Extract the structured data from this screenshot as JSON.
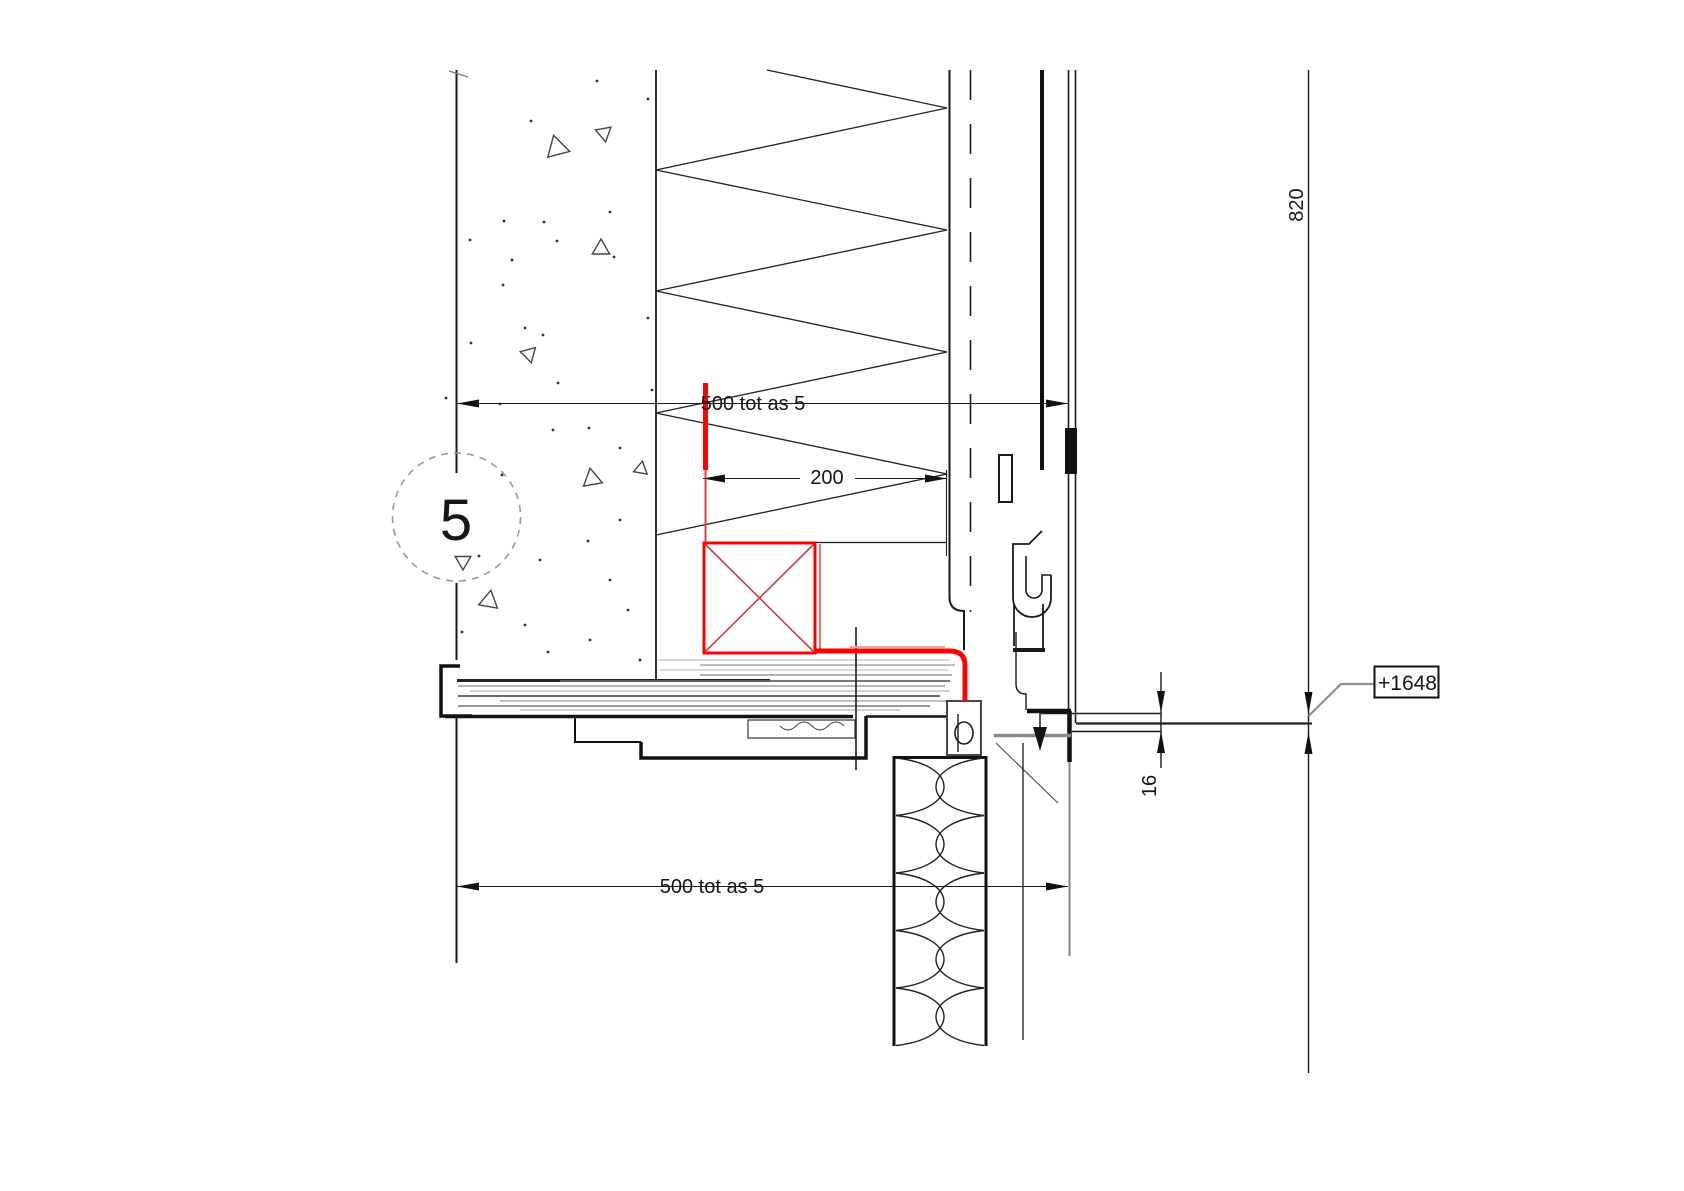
{
  "drawing_labels": {
    "dim_top": "500 tot as 5",
    "dim_mid": "200",
    "dim_bottom": "500 tot as 5",
    "dim_height": "820",
    "dim_gap": "16",
    "grid_bubble": "5",
    "level_tag": "+1648"
  },
  "colors": {
    "red_accent": "#ff0000",
    "red_soft": "#e04040",
    "red_light": "#ff9a9a",
    "line_dark": "#1a1a1a",
    "grain_gray": "#9a9a9a",
    "bar_gray": "#8a8a8a",
    "leader_gray": "#8f8f8f"
  },
  "stipple": {
    "dots": [
      [
        597,
        81
      ],
      [
        648,
        99
      ],
      [
        531,
        121
      ],
      [
        504,
        221
      ],
      [
        544,
        222
      ],
      [
        512,
        260
      ],
      [
        557,
        241
      ],
      [
        470,
        240
      ],
      [
        610,
        212
      ],
      [
        503,
        285
      ],
      [
        614,
        257
      ],
      [
        648,
        318
      ],
      [
        525,
        328
      ],
      [
        543,
        335
      ],
      [
        471,
        343
      ],
      [
        558,
        383
      ],
      [
        652,
        390
      ],
      [
        446,
        398
      ],
      [
        500,
        404
      ],
      [
        589,
        428
      ],
      [
        553,
        430
      ],
      [
        620,
        448
      ],
      [
        502,
        475
      ],
      [
        620,
        520
      ],
      [
        588,
        541
      ],
      [
        479,
        556
      ],
      [
        540,
        560
      ],
      [
        610,
        580
      ],
      [
        628,
        610
      ],
      [
        525,
        625
      ],
      [
        590,
        640
      ],
      [
        548,
        652
      ],
      [
        640,
        660
      ],
      [
        462,
        632
      ]
    ],
    "triangles": [
      [
        557,
        148,
        13,
        15
      ],
      [
        604,
        133,
        9,
        200
      ],
      [
        601,
        249,
        10,
        30
      ],
      [
        529,
        354,
        9,
        195
      ],
      [
        592,
        479,
        11,
        20
      ],
      [
        641,
        469,
        8,
        40
      ],
      [
        463,
        561,
        9,
        210
      ],
      [
        489,
        601,
        11,
        160
      ]
    ]
  },
  "grain_lines": [
    [
      660,
      658,
      950,
      "#b0b0b0",
      1.1
    ],
    [
      665,
      700,
      955,
      "#999999",
      1.2
    ],
    [
      670,
      660,
      948,
      "#b5b5b5",
      1.0
    ],
    [
      675,
      700,
      952,
      "#999999",
      1.5
    ],
    [
      681,
      560,
      950,
      "#666666",
      1.8
    ],
    [
      686,
      458,
      945,
      "#8a8a8a",
      1.2
    ],
    [
      691,
      470,
      950,
      "#a5a5a5",
      1.0
    ],
    [
      696,
      458,
      940,
      "#555555",
      1.8
    ],
    [
      701,
      500,
      948,
      "#9a9a9a",
      1.2
    ],
    [
      706,
      458,
      930,
      "#777777",
      1.4
    ],
    [
      710,
      520,
      900,
      "#aaaaaa",
      1.0
    ]
  ],
  "batt_hatch": {
    "x1": 894,
    "x2": 986,
    "y_top": 758,
    "cell_h": 57.5,
    "cells": 5
  }
}
